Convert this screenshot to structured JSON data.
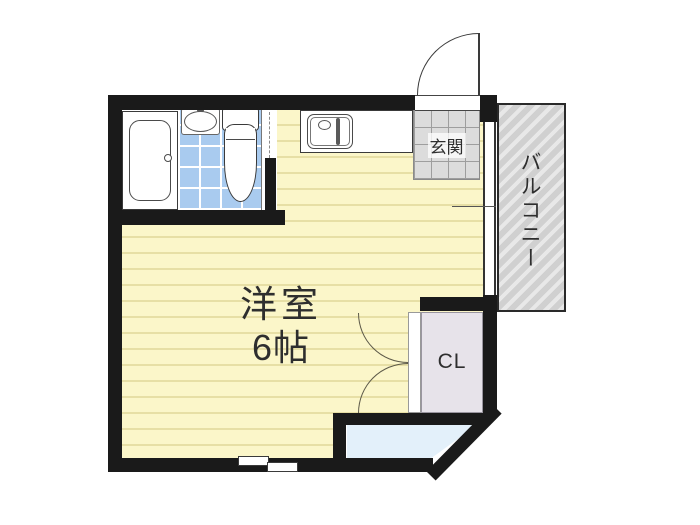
{
  "plan": {
    "rooms": {
      "main": {
        "label": "洋室",
        "size": "6帖"
      },
      "entrance": {
        "label": "玄関"
      },
      "balcony": {
        "label": "バルコニー"
      },
      "closet": {
        "label": "CL"
      }
    },
    "fixtures": [
      "bathtub-icon",
      "washbasin-icon",
      "toilet-icon",
      "kitchen-sink-icon",
      "entry-door-arc-icon",
      "closet-double-door-icon",
      "sliding-window-icon"
    ],
    "colors": {
      "wall": "#1a1a1a",
      "room_fill": "#FBF6C9",
      "tatami_line": "#E7DFA5",
      "balcony_fill": "#D0D0D0",
      "balcony_stripe": "#E8E8E8",
      "tile_blue": "#A9CBEF",
      "genkan_tile": "#DCDCDC",
      "genkan_grid": "#9E9E9E",
      "closet_fill": "#E7E3EA",
      "bay_fill": "#E3F0FA",
      "text": "#2E2E2E",
      "outline": "#3A3A3A"
    }
  }
}
